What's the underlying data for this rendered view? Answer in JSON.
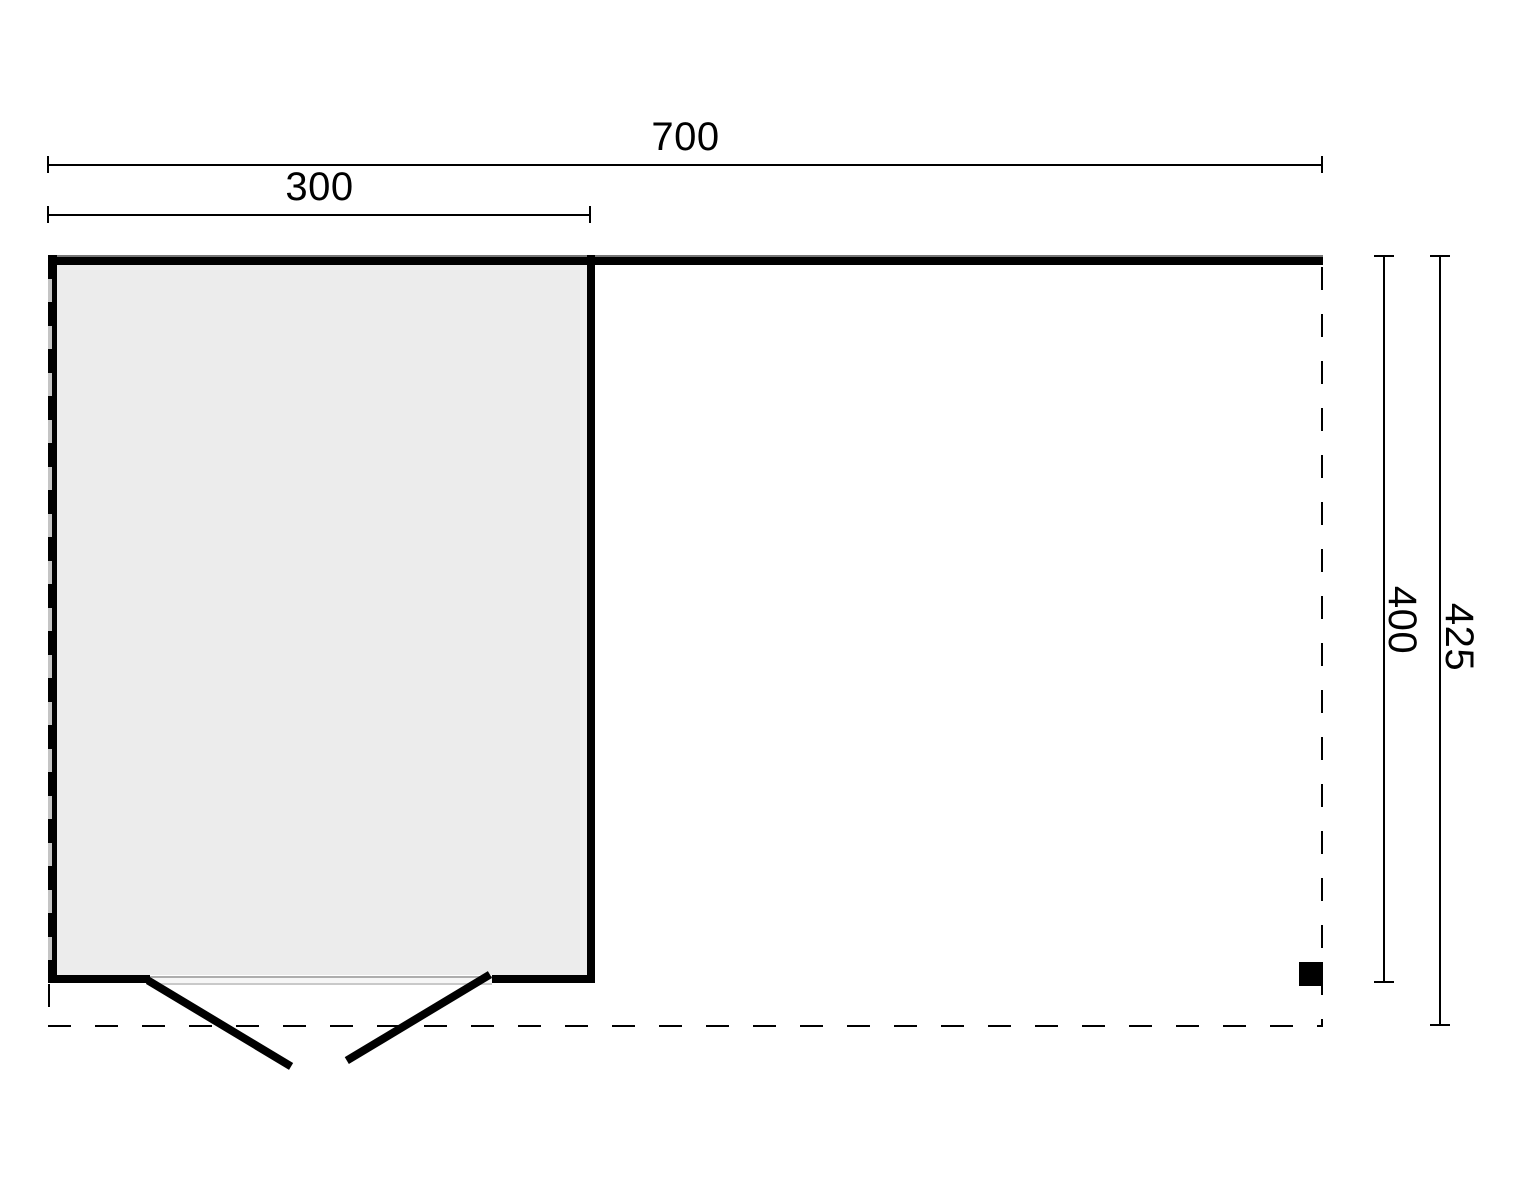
{
  "floor_plan": {
    "background_color": "#ffffff",
    "line_color": "#000000",
    "room_fill_color": "#ececec",
    "dimensions": {
      "total_width": "700",
      "room_width": "300",
      "room_depth": "400",
      "total_depth": "425"
    }
  }
}
